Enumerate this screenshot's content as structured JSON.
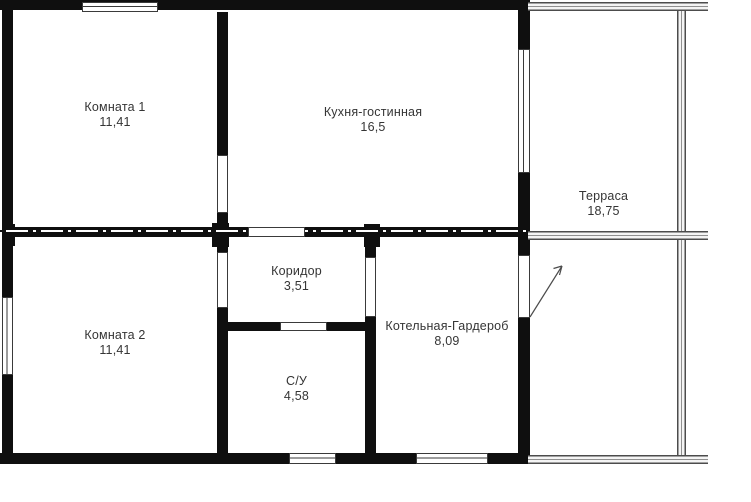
{
  "plan_type": "floor-plan",
  "rooms": [
    {
      "id": "komnata-1",
      "name": "Комната 1",
      "area": "11,41"
    },
    {
      "id": "kuhnya-gostinnaya",
      "name": "Кухня-гостинная",
      "area": "16,5"
    },
    {
      "id": "terrasa",
      "name": "Терраса",
      "area": "18,75"
    },
    {
      "id": "komnata-2",
      "name": "Комната 2",
      "area": "11,41"
    },
    {
      "id": "koridor",
      "name": "Коридор",
      "area": "3,51"
    },
    {
      "id": "s-u",
      "name": "С/У",
      "area": "4,58"
    },
    {
      "id": "kotelnaya-garderob",
      "name": "Котельная-Гардероб",
      "area": "8,09"
    }
  ],
  "colors": {
    "wall": "#0f0f0f",
    "background": "#ffffff",
    "text": "#353535",
    "railing": "#4c4c4c",
    "window_frame": "#3a3a3a"
  }
}
